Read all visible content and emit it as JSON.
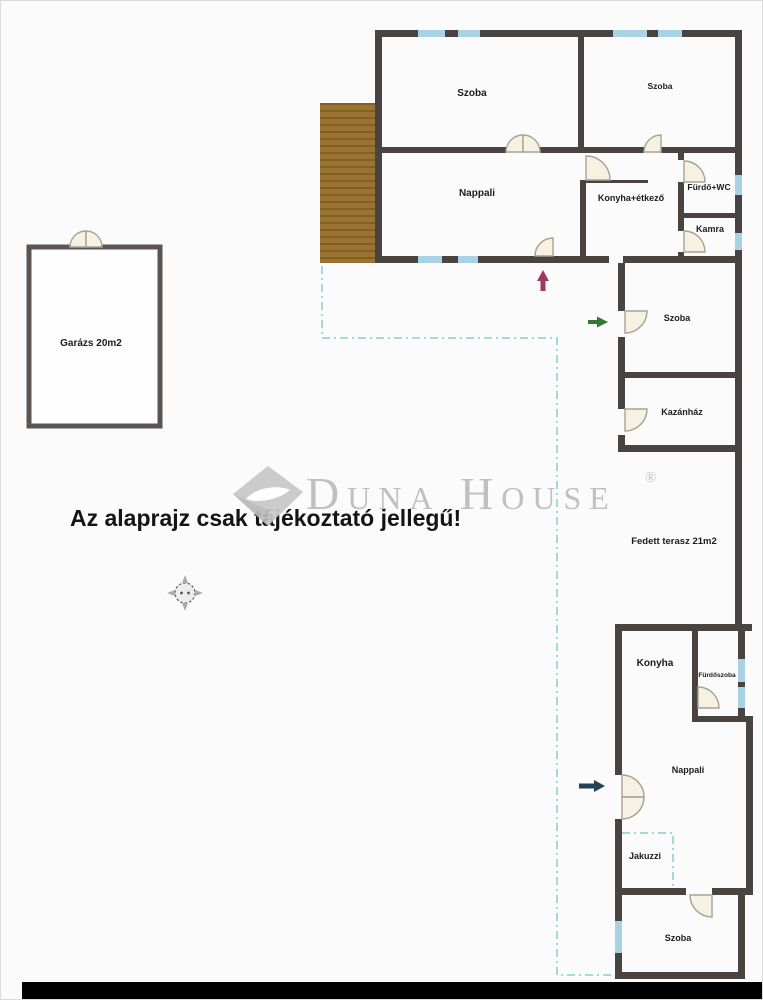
{
  "rooms": {
    "szoba_top_left": "Szoba",
    "szoba_top_right": "Szoba",
    "nappali_top": "Nappali",
    "konyha_etkezo": "Konyha+étkező",
    "furdo_wc": "Fürdő+WC",
    "kamra": "Kamra",
    "garazs": "Garázs 20m2",
    "szoba_right": "Szoba",
    "kazanhaz": "Kazánház",
    "fedett_terasz": "Fedett terasz 21m2",
    "konyha_also": "Konyha",
    "furdoszoba": "Fürdőszoba",
    "nappali_also": "Nappali",
    "jakuzzi": "Jakuzzi",
    "szoba_also": "Szoba"
  },
  "watermark": {
    "brand": "Duna House",
    "registered": "®"
  },
  "disclaimer": "Az alaprajz csak tájékoztató jellegű!",
  "colors": {
    "wall": "#4a4440",
    "garage_wall": "#5a5551",
    "window": "#a9d2e4",
    "deck": "#9a7334",
    "deck_stripe": "#82611f",
    "dashed_outline": "#8fd2d8",
    "door_fill": "#f7f1e3",
    "watermark_gray": "#bcbcbc",
    "arrow_entrance_up": "#9c3a60",
    "arrow_entrance_green": "#2f7a33",
    "arrow_entrance_blue": "#24415a",
    "background": "#fbfbfb",
    "bottom_band": "#000000"
  }
}
